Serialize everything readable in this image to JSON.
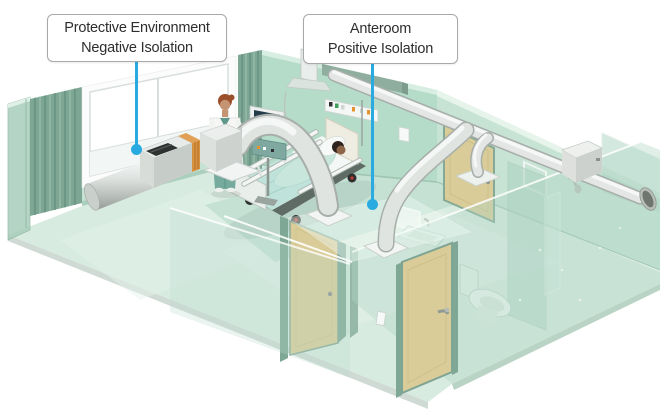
{
  "callouts": {
    "protective": {
      "line1": "Protective Environment",
      "line2": "Negative Isolation"
    },
    "anteroom": {
      "line1": "Anteroom",
      "line2": "Positive Isolation"
    }
  },
  "colors": {
    "leader": "#29abe2",
    "label_border": "#a9a9a9",
    "label_text": "#2e2e2e",
    "label_bg": "#ffffff",
    "floor": "#d8ebe1",
    "wall": "#b5dcc9",
    "glass": "#a9cfbd",
    "curtain": "#7da695",
    "door": "#d9cc98",
    "door_frame": "#7fa795",
    "duct_light": "#e2e5e3",
    "duct_dark": "#a7aeaa",
    "blanket": "#bfe3da",
    "scrubs": "#76aa9d"
  },
  "scene": {
    "elements": [
      "patient-room",
      "anteroom",
      "bathroom",
      "hospital-bed",
      "patient",
      "nurse",
      "vital-signs-monitor",
      "exhaust-duct-unit",
      "overbed-supply-duct",
      "anteroom-supply-duct",
      "ceiling-duct-run",
      "duct-wall-exit",
      "window",
      "privacy-curtains",
      "medical-gas-panel",
      "ceiling-pendant",
      "anteroom-door",
      "bathroom-door",
      "entry-door",
      "handwash-sink",
      "toilet",
      "shower"
    ]
  }
}
